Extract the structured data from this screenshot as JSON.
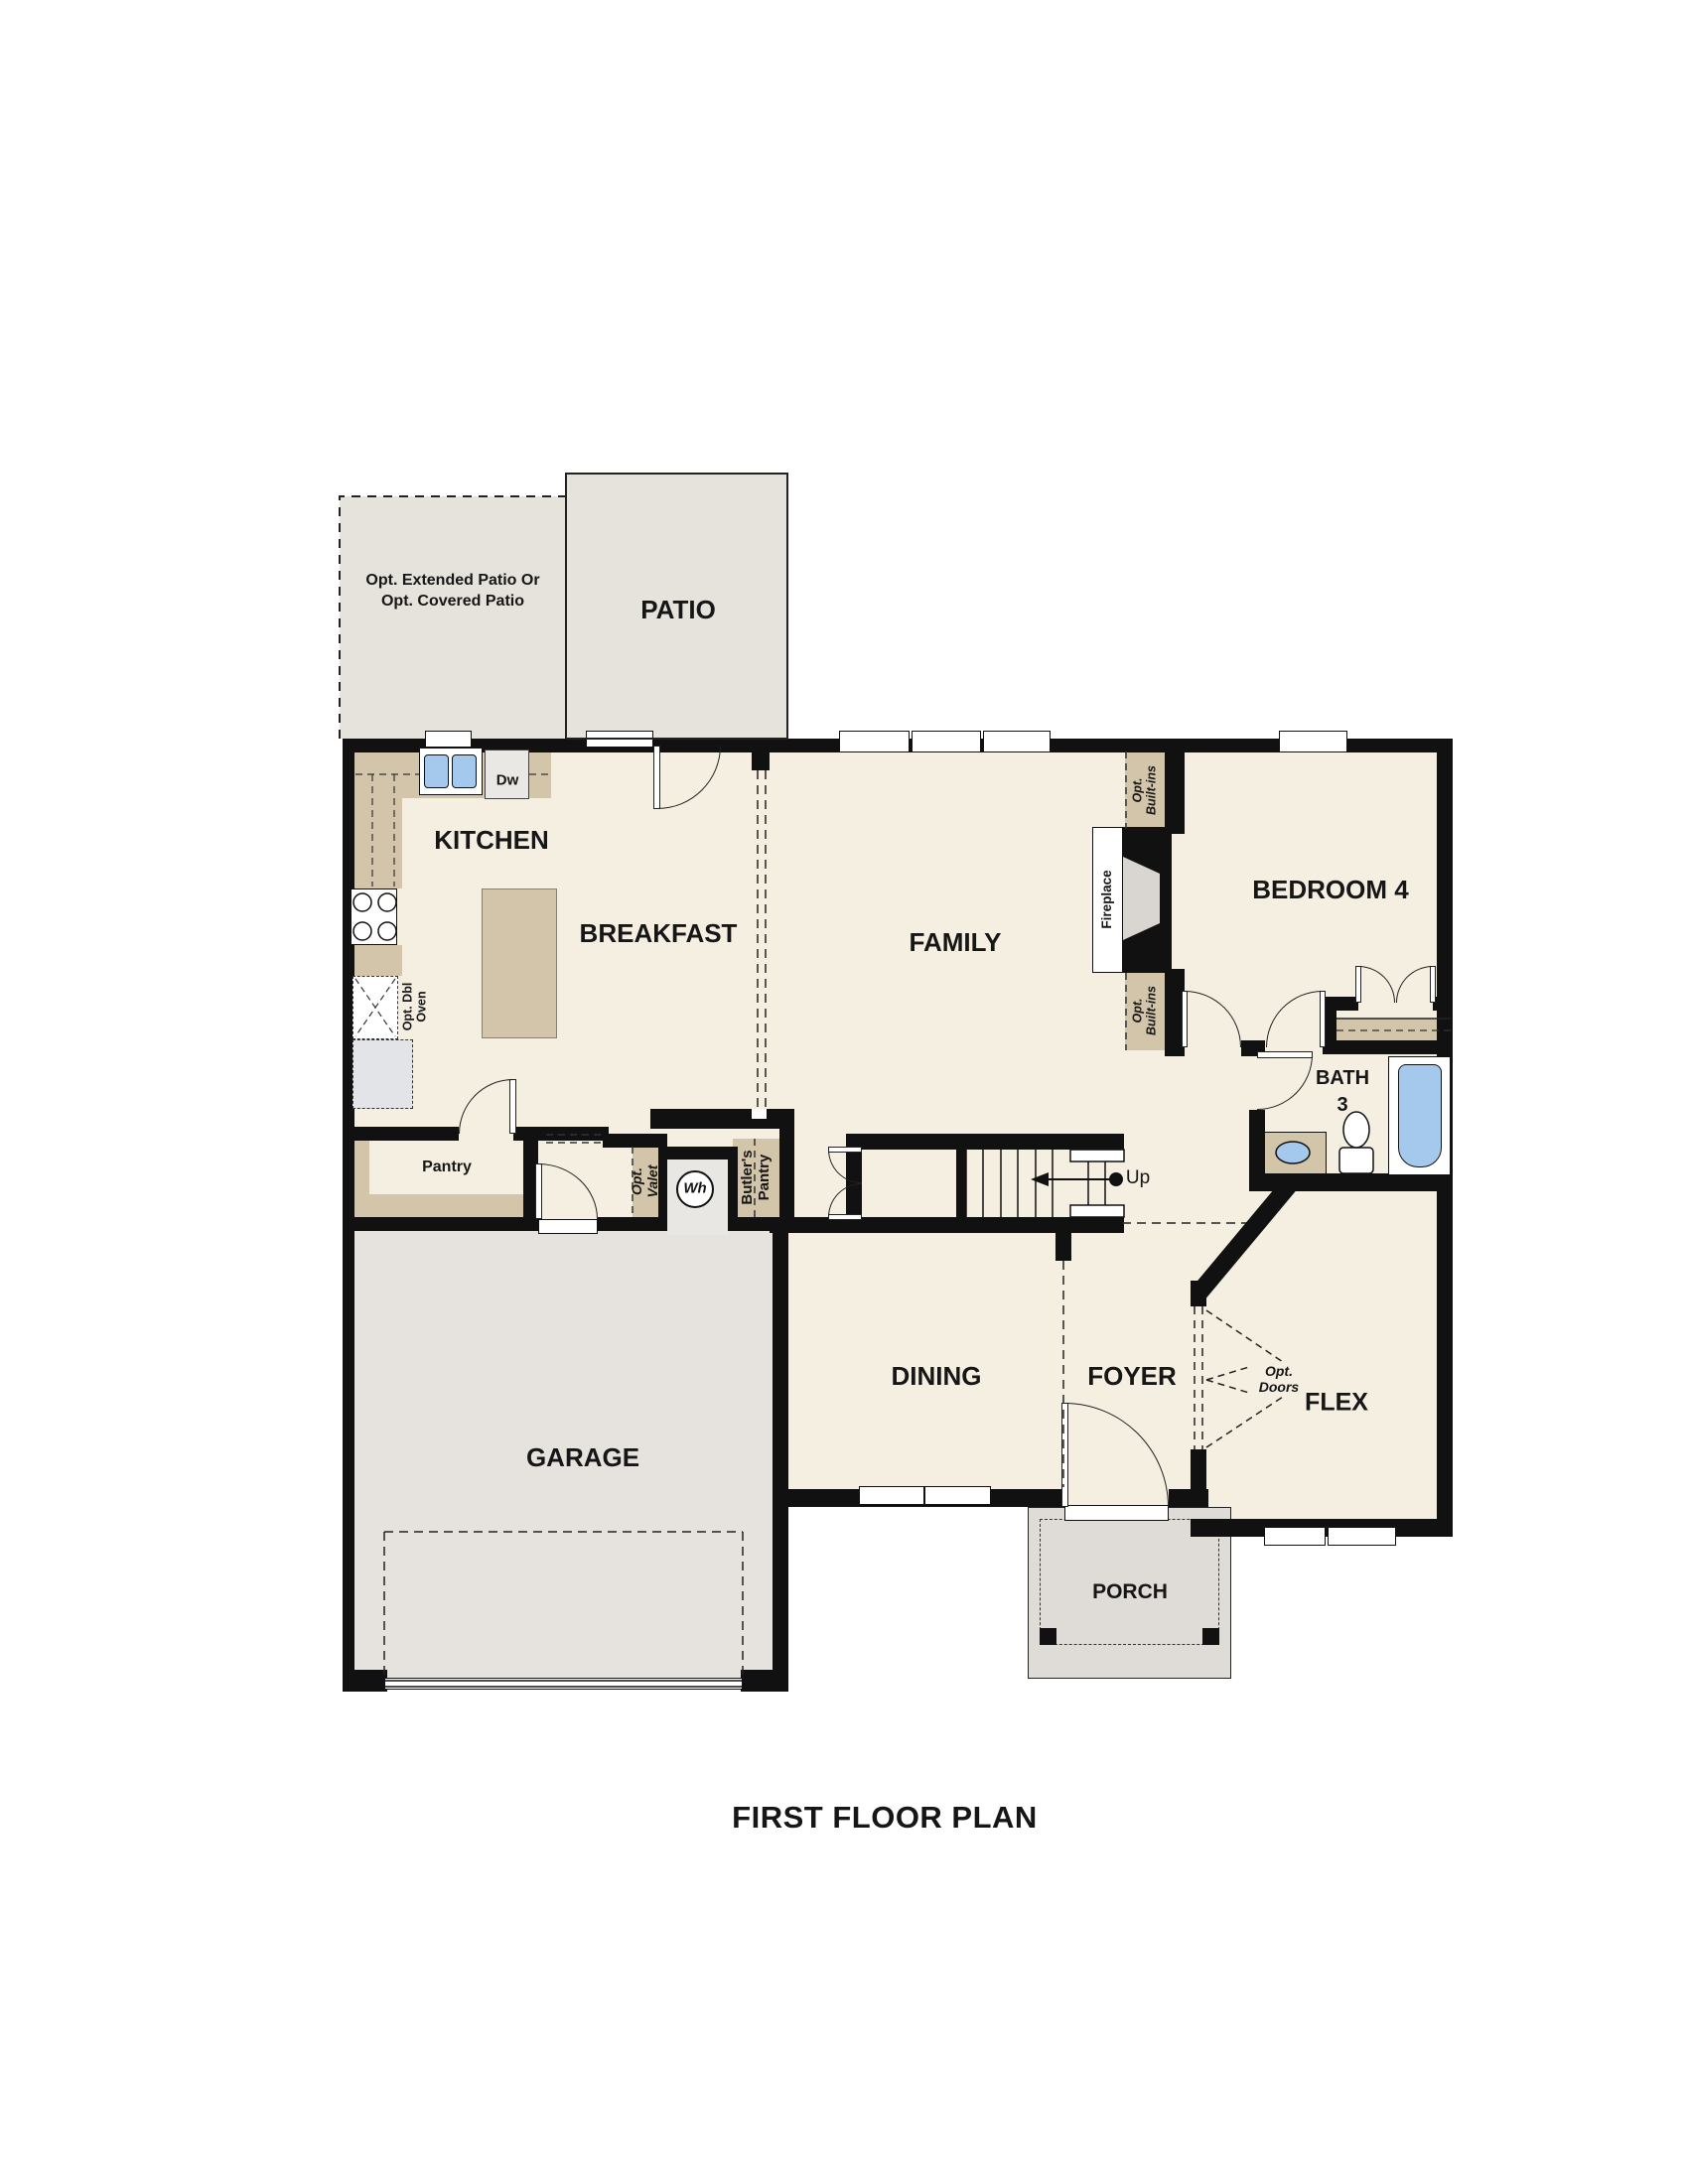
{
  "title": "FIRST FLOOR PLAN",
  "rooms": {
    "kitchen": "KITCHEN",
    "breakfast": "BREAKFAST",
    "family": "FAMILY",
    "bedroom4": "BEDROOM 4",
    "bath3": "BATH\n3",
    "dining": "DINING",
    "foyer": "FOYER",
    "flex": "FLEX",
    "garage": "GARAGE",
    "porch": "PORCH",
    "patio": "PATIO"
  },
  "labels": {
    "patio_option": "Opt. Extended Patio Or\nOpt. Covered Patio",
    "pantry": "Pantry",
    "butlers_pantry": "Butler's\nPantry",
    "opt_valet": "Opt.\nValet",
    "water_heater": "Wh",
    "dishwasher": "Dw",
    "up": "Up",
    "opt_dbl_oven": "Opt. Dbl\nOven",
    "fireplace": "Fireplace",
    "opt_built_ins": "Opt.\nBuilt-ins",
    "opt_doors": "Opt.\nDoors"
  },
  "colors": {
    "wall": "#111111",
    "floor": "#f5efe2",
    "patio": "#e6e3dd",
    "garage": "#e6e3de",
    "porch": "#dfdbd6",
    "counter_tan": "#d3c5a9",
    "fixture_blue": "#a5c8ed",
    "appliance_gray": "#e3e4e8"
  }
}
